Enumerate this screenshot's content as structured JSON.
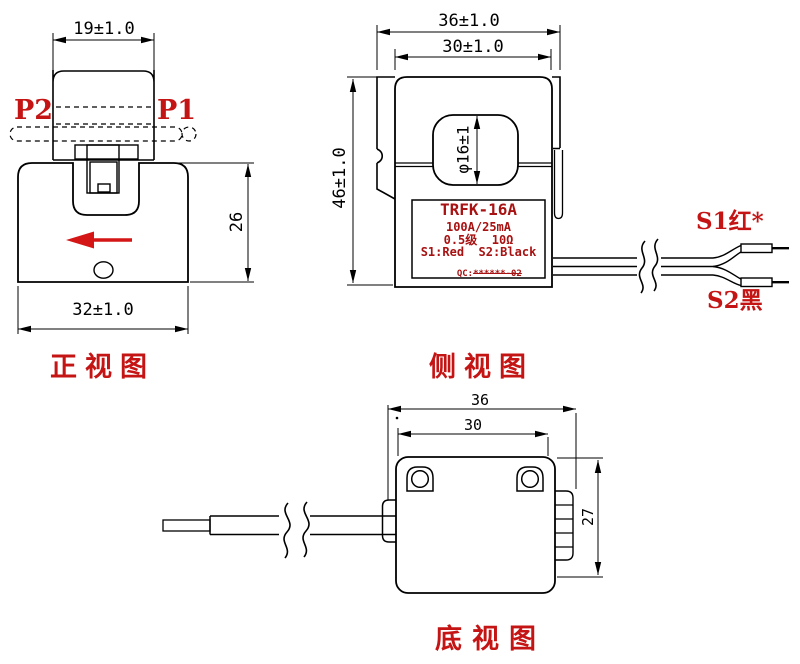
{
  "colors": {
    "line": "#000000",
    "accent_red": "#c41414",
    "nameplate_red": "#a81212",
    "arrow_red": "#d41616"
  },
  "front_view": {
    "title": "正视图",
    "dim_top_width": "19±1.0",
    "dim_body_width": "32±1.0",
    "dim_body_height": "26",
    "terminal_left": "P2",
    "terminal_right": "P1"
  },
  "side_view": {
    "title": "侧视图",
    "dim_outer_width": "36±1.0",
    "dim_inner_width": "30±1.0",
    "dim_height": "46±1.0",
    "dim_hole": "φ16±1",
    "nameplate": {
      "model": "TRFK-16A",
      "ratio": "100A/25mA",
      "class_burden": "0.5级  10Ω",
      "leads": "S1:Red  S2:Black",
      "qc_prefix": "QC:",
      "qc_code": "******-02"
    },
    "wire_label_top": "S1红*",
    "wire_label_bottom": "S2黑"
  },
  "bottom_view": {
    "title": "底视图",
    "dim_outer_width": "36",
    "dim_inner_width": "30",
    "dim_height": "27"
  }
}
